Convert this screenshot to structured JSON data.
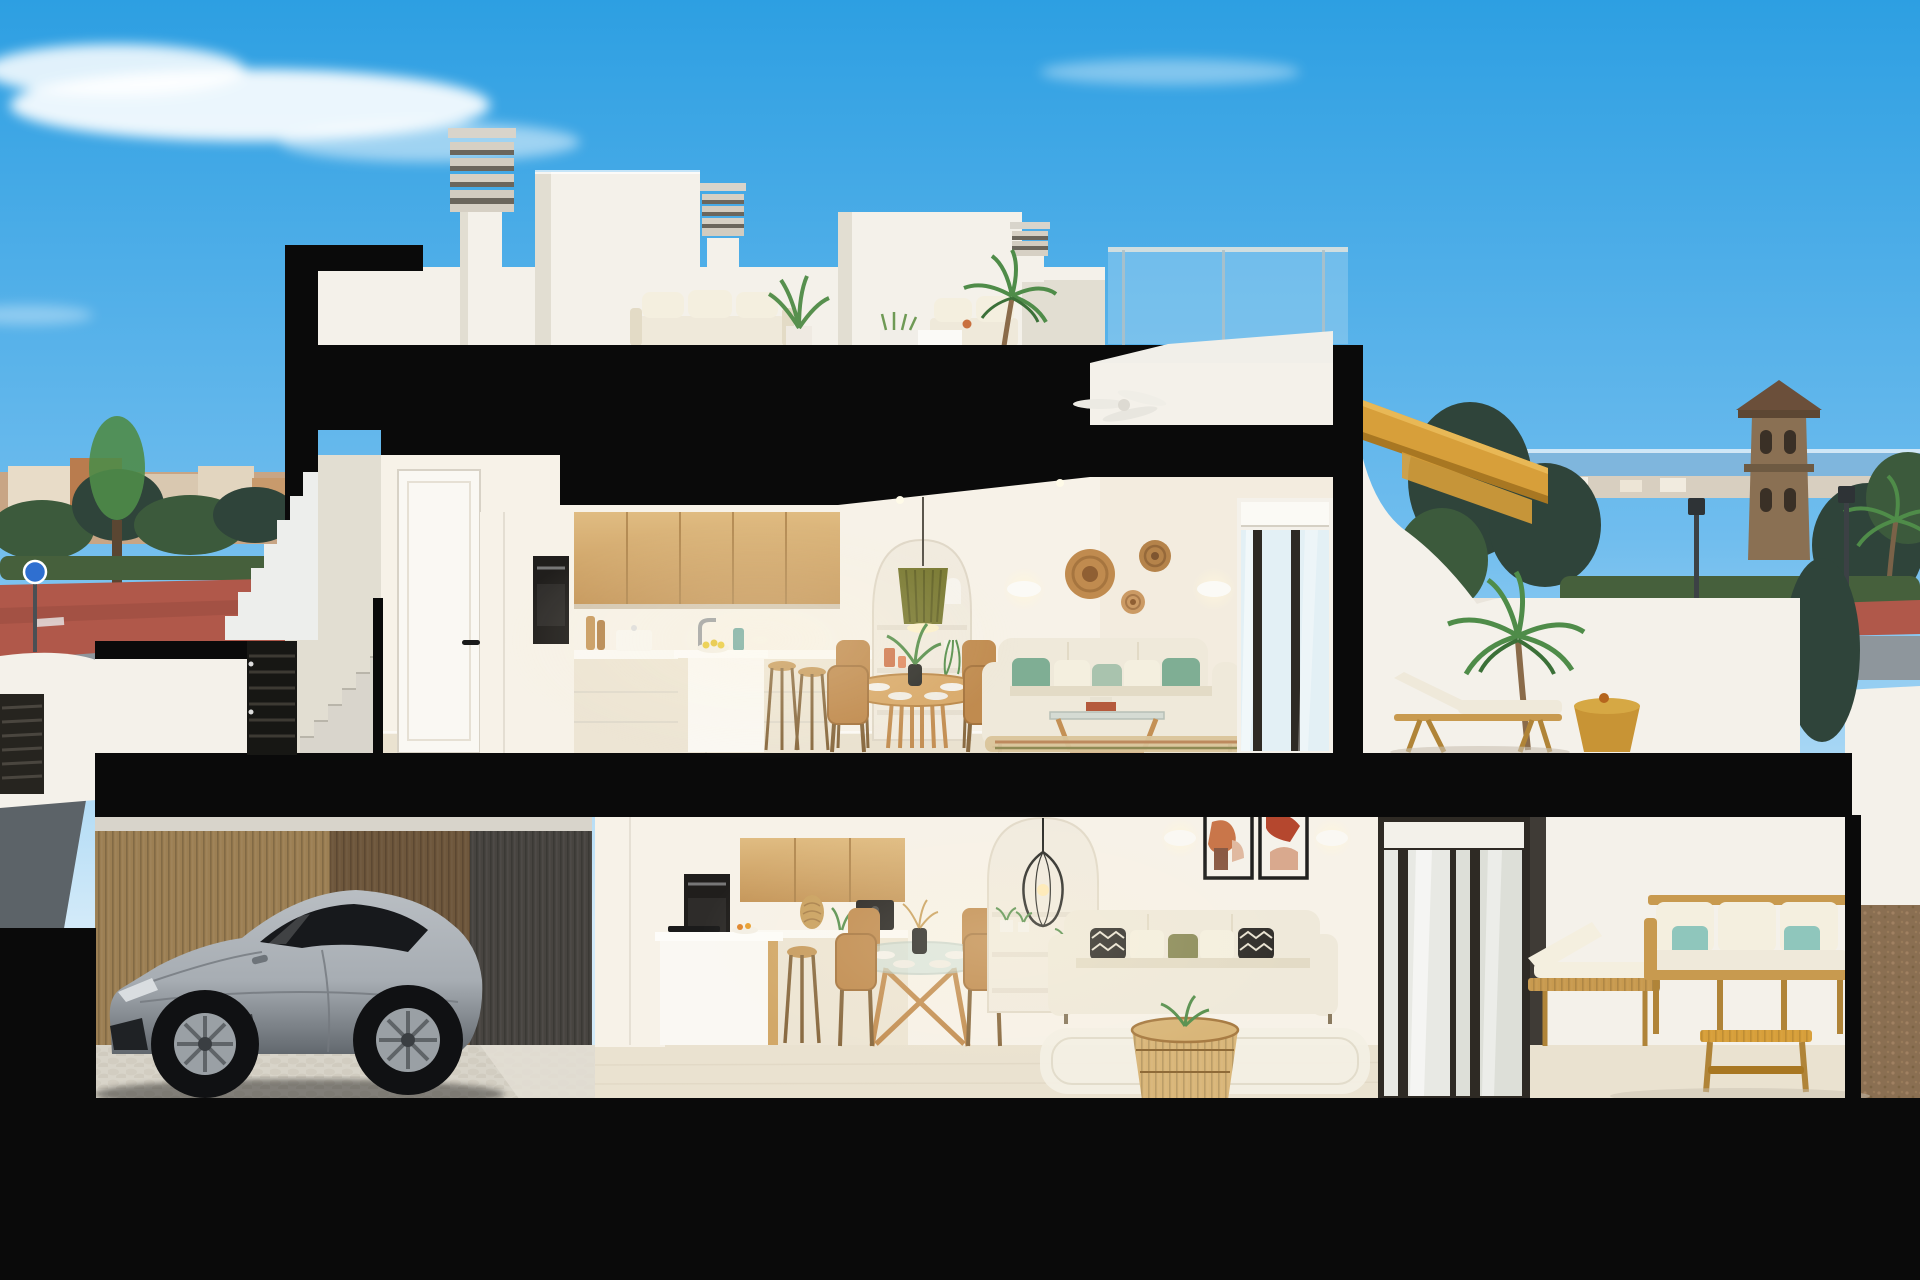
{
  "scene": {
    "kind": "architectural-cross-section-3d-render",
    "setting": "two-storey coastal duplex cut open: roof terrace, upper living floor with terrace, lower floor with garage, living space and patio",
    "sky": "clear blue day with wispy clouds"
  },
  "colors": {
    "sky_top": "#2D9FE2",
    "sky_mid": "#70BDEE",
    "sky_horizon": "#D2EAF9",
    "cloud": "#FFFFFF",
    "cut": "#0A0A0A",
    "wall": "#F4F1EA",
    "wall_shade": "#E2DED2",
    "int_wall": "#F7F2E8",
    "int_wall_shade": "#EDE5D4",
    "floor": "#EAE2D0",
    "door_white": "#FAF8F3",
    "oven": "#201E1C",
    "wood_light": "#E0BC82",
    "wood_dark": "#C59659",
    "wood_seam": "#A87F49",
    "sofa": "#EFE9DA",
    "sofa_shade": "#E3DBC6",
    "pillow_green": "#7FAE94",
    "pillow_sage": "#A9C3AE",
    "pillow_cream": "#F4EFDF",
    "pillow_dark": "#2E2C29",
    "pillow_olive": "#8A8A58",
    "rug_jute": "#D9C49A",
    "rug_white": "#F3EFE4",
    "rattan": "#C08B4F",
    "rattan_dark": "#8F6B38",
    "pendant_green": "#7A7A33",
    "glass": "#DFF0F7",
    "mullion": "#2E2A24",
    "stair_gold": "#D79F3A",
    "stair_gold_dark": "#A87722",
    "mustard": "#C89435",
    "teal": "#8FC6BC",
    "timber": "#C89A4F",
    "timber_dark": "#B08438",
    "car_body_hi": "#B9BEC3",
    "car_body": "#A7ADB3",
    "car_body_lo": "#62686E",
    "car_glass": "#17191C",
    "rim": "#9AA0A5",
    "bamboo": "#9C7F53",
    "bamboo_mid": "#7E6345",
    "bamboo_dark": "#474440",
    "cobble": "#D8D4C9",
    "street_red": "#B0584A",
    "asphalt": "#8E969C",
    "asphalt_dark": "#5C6368",
    "sea": "#7FB6DD",
    "town": "#C8A585",
    "tree": "#3C5A3C",
    "tree_dark": "#2F443A",
    "hedge": "#46603C",
    "tower": "#8A7053",
    "tower_roof": "#6B4F3A",
    "gravel": "#8A6F52",
    "sign_blue": "#2F6FD0",
    "concrete": "#D9D5CC",
    "palm_green": "#4F8C49",
    "palm_dark": "#3B7038",
    "plant_green": "#57904E"
  },
  "objects": {
    "roof_level": [
      "louvered chimney tall",
      "louvered chimney small",
      "stair bulkhead volume",
      "white outdoor sofa set",
      "potted leafy plant",
      "tall potted palm",
      "glass roof railing",
      "white parapet"
    ],
    "upper_floor": [
      "entry door with black handle",
      "exterior entry stair",
      "oak upper kitchen cabinets",
      "built-in oven column",
      "kitchen island with fruit bowl",
      "two wooden bar stools",
      "round wooden dining table with rattan chairs",
      "green pleated pendant lamp",
      "arched shelving niche with decor",
      "two white wall sconces",
      "three woven wall baskets",
      "cream sofa with green cushions",
      "wood and glass coffee table",
      "striped jute rug",
      "white sliding glass door",
      "ceiling fan"
    ],
    "upper_terrace": [
      "golden timber exterior stair",
      "curved white stair wall",
      "wooden sun lounger with white pad",
      "mustard side table",
      "large potted palm",
      "white parapet"
    ],
    "lower_floor": [
      "bamboo slat fence",
      "silver sports coupe",
      "cobbled driveway",
      "oak upper cabinets",
      "built-in oven column",
      "coffee machine",
      "white island with hob and bar stool",
      "round glass dining table with amber chairs",
      "black wire pendant lamp",
      "arched shelving niche with plants",
      "two framed abstract artworks",
      "two white wall sconces",
      "cream sofa with patterned cushions",
      "rattan drum coffee table",
      "white rug",
      "dark sliding glass door"
    ],
    "lower_terrace": [
      "timber outdoor sofa with teal cushions",
      "timber chaise",
      "slatted timber coffee table"
    ],
    "background": [
      "town skyline with trees",
      "red sidewalk and grey street",
      "round blue traffic sign",
      "white boundary wall with louvered gate",
      "sea horizon strip",
      "watchtower with tiled roof",
      "dark conifers",
      "hedgerow",
      "street lamps",
      "palm trees",
      "white planter wall",
      "gravel side yard"
    ]
  }
}
